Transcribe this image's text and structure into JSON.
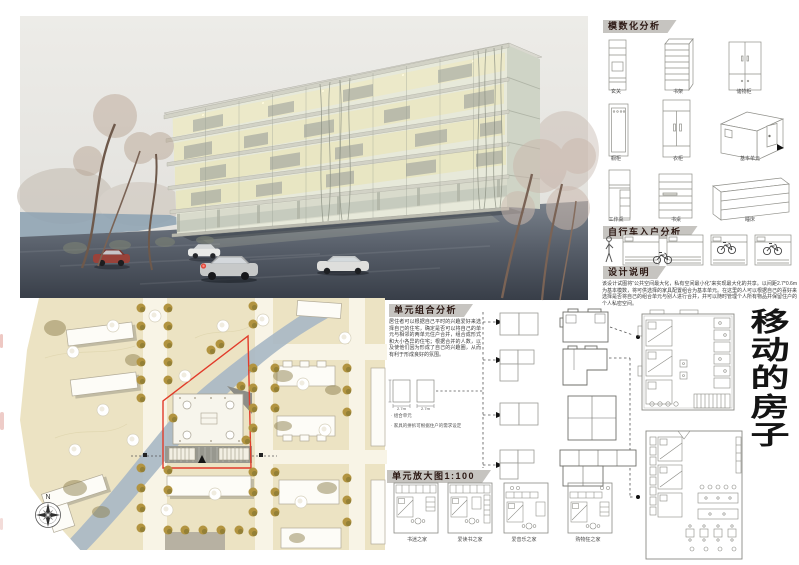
{
  "colors": {
    "accent_red": "#e23b2a",
    "header_band": "#c6c4c0",
    "header_text": "#2b1712",
    "title_text": "#141414",
    "water": "#aab9c6",
    "land": "#ece3c3",
    "olive_tree": "#b29440"
  },
  "title": {
    "text": "移动的房子",
    "chars": [
      "移",
      "动",
      "的",
      "房",
      "子"
    ]
  },
  "modular": {
    "header": "模数化分析",
    "items": [
      {
        "label": "玄关"
      },
      {
        "label": "书架"
      },
      {
        "label": "储物柜"
      },
      {
        "label": "橱柜"
      },
      {
        "label": "衣柜"
      },
      {
        "label": "基本单元"
      },
      {
        "label": "工作桌"
      },
      {
        "label": "书桌"
      },
      {
        "label": "睡床"
      }
    ]
  },
  "bicycle": {
    "header": "自行车入户分析"
  },
  "design_notes": {
    "header": "设计说明",
    "body": "该设计试图将“公共空间最大化，私有空间最小化”来实现最大化的共享。以间距2.7*0.6m为基本模数，将可供选择的家具配置组合为基本单元。在这里的人可以根据自己的喜好来选择是否将自己的组合单元与别人进行合并，并可以随时管理个人所有物品并保留住户的个人私密空间。"
  },
  "unit_combination": {
    "header": "单元组合分析",
    "body": "居住者可以根据自己平时的兴趣爱好来选择自己的住宅，确定是否可以将自己的单元与相邻的两单元住户合并，组合成形式和大小各异的住宅；根据合并的人数，以及使他们因为形成了自己的兴趣圈，从而有利于形成良好的氛围。",
    "dim_left": "2.7m",
    "dim_right": "2.7m",
    "note1": "组合单元",
    "note2": "家具的拼拆可根据住户的需求设定"
  },
  "unit_enlarged": {
    "header": "单元放大图1:100",
    "plans": [
      {
        "label": "书迷之家"
      },
      {
        "label": "爱读书之家"
      },
      {
        "label": "爱音乐之家"
      },
      {
        "label": "购物狂之家"
      }
    ]
  },
  "site_plan": {
    "compass": "N"
  }
}
